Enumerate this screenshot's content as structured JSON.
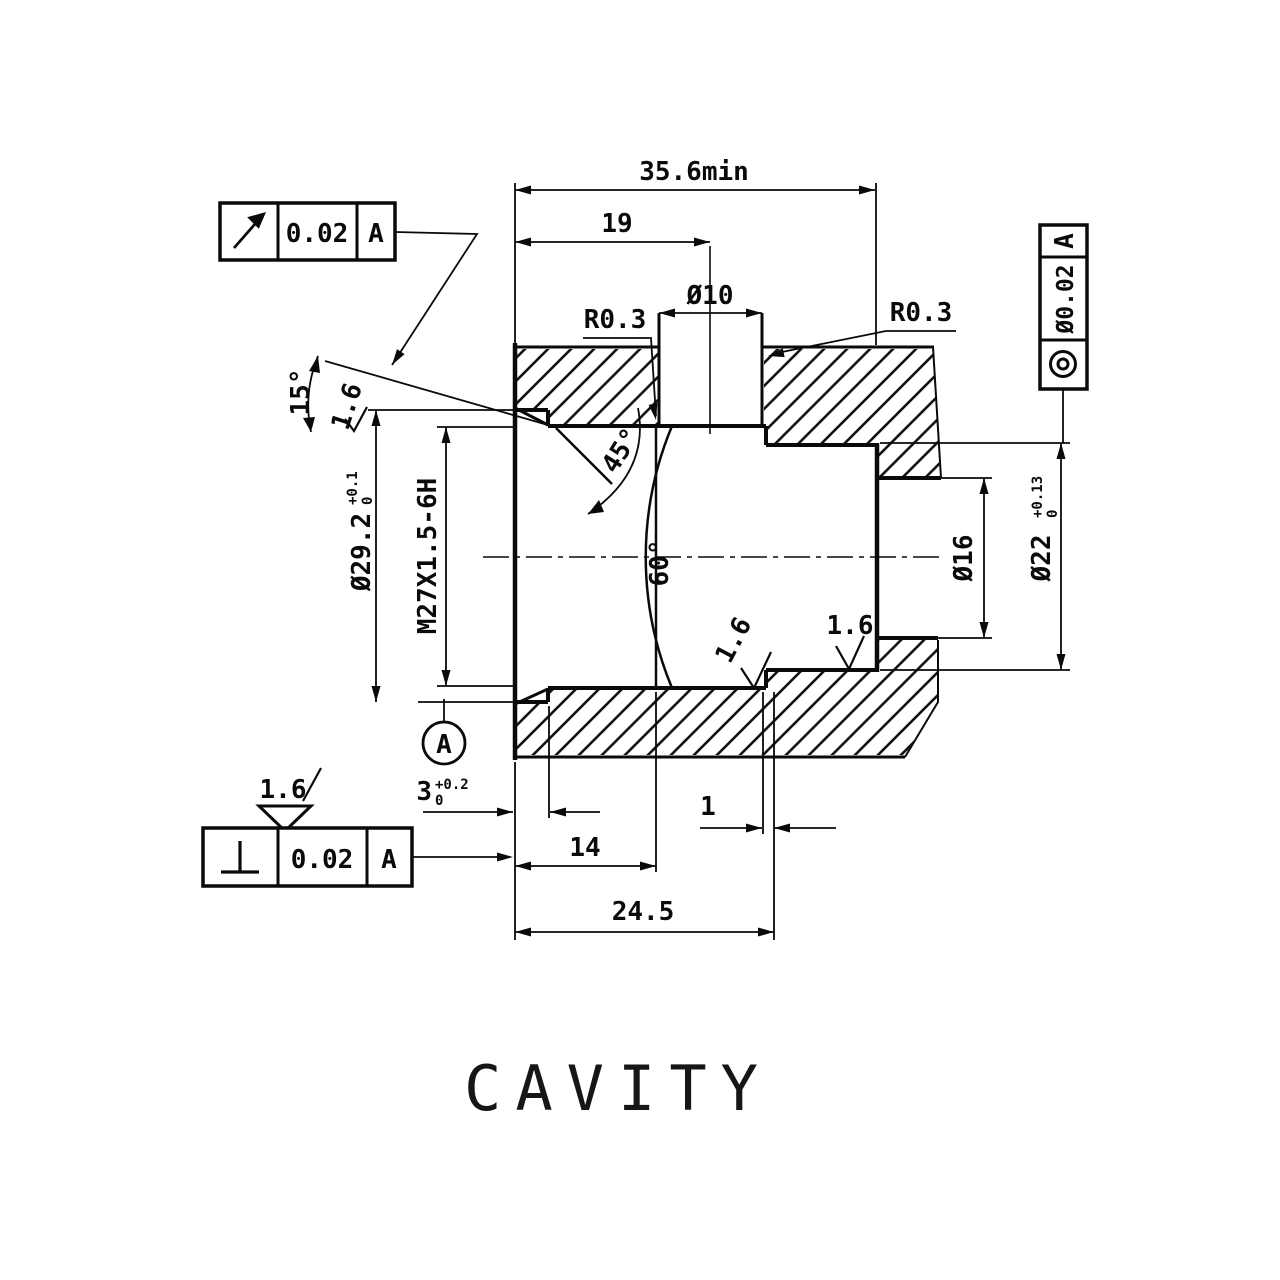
{
  "drawing": {
    "title": "CAVITY",
    "dims": {
      "total_min": "35.6min",
      "hole_pos": "19",
      "cross_hole_dia": "Ø10",
      "radius_left": "R0.3",
      "radius_right": "R0.3",
      "entry_angle": "15°",
      "counterbore_dia": "Ø29.2",
      "counterbore_dia_tol_up": "+0.1",
      "counterbore_dia_tol_low": "0",
      "thread_spec": "M27X1.5-6H",
      "chamfer_angle": "45°",
      "cone_angle": "60°",
      "bore_dia_22": "Ø22",
      "bore_dia_22_tol_up": "+0.13",
      "bore_dia_22_tol_low": "0",
      "bore_dia_16": "Ø16",
      "counterbore_depth": "3",
      "counterbore_depth_tol_up": "+0.2",
      "counterbore_depth_tol_low": "0",
      "land_width": "1",
      "thread_depth": "14",
      "bore_depth": "24.5"
    },
    "surface_finish": {
      "entry": "1.6",
      "cone": "1.6",
      "bore": "1.6",
      "general": "1.6"
    },
    "gdt": {
      "runout_tol": "0.02",
      "runout_datum": "A",
      "perp_tol": "0.02",
      "perp_datum": "A",
      "conc_tol": "Ø0.02",
      "conc_datum": "A",
      "datum_label": "A"
    }
  }
}
